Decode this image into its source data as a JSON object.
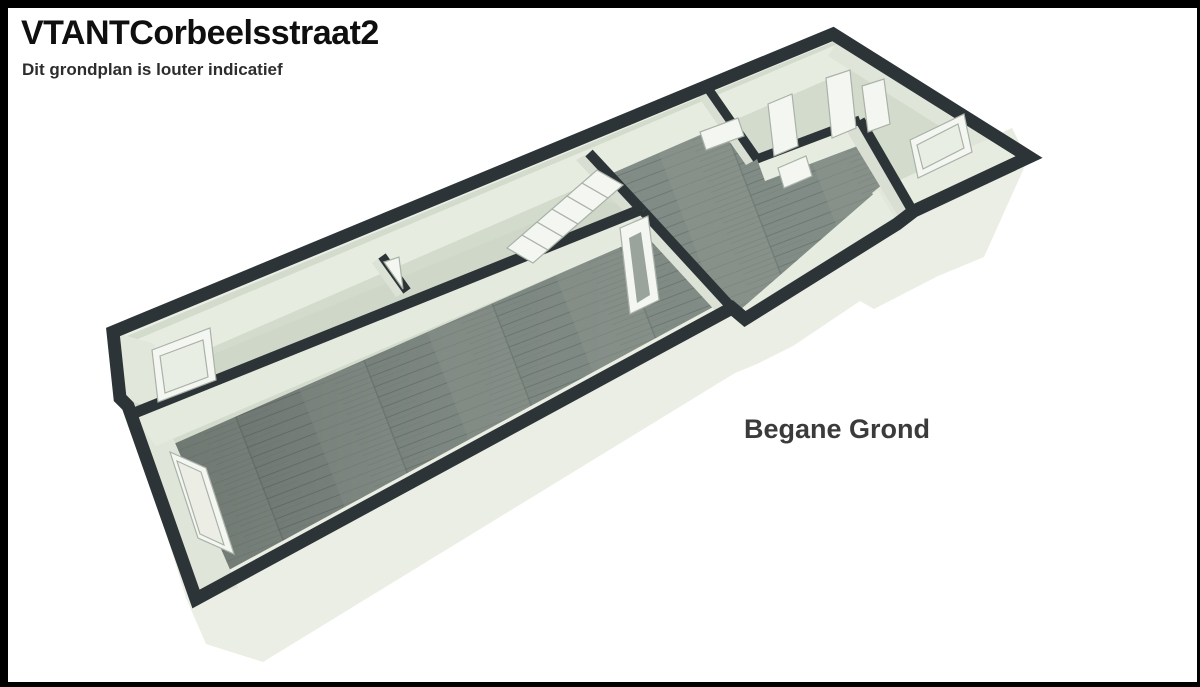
{
  "page": {
    "background": "#ffffff",
    "frame_color": "#000000"
  },
  "header": {
    "title": "VTANTCorbeelsstraat2",
    "subtitle": "Dit grondplan is louter indicatief"
  },
  "floorplan": {
    "label": "Begane Grond",
    "view": "3D dollhouse perspective floor plan",
    "colors": {
      "wall_top": "#2c3437",
      "wall_face_light": "#e7ece1",
      "wall_face_shaded": "#d9dfd3",
      "floor_base": "#d3dbcd",
      "floor_back_strip": "#cfd7c9",
      "wood_floor": "#828c86",
      "exterior_wall": "#ebeee4",
      "white_fixture": "#f4f6f1",
      "label_color": "#3b3b3b"
    }
  }
}
